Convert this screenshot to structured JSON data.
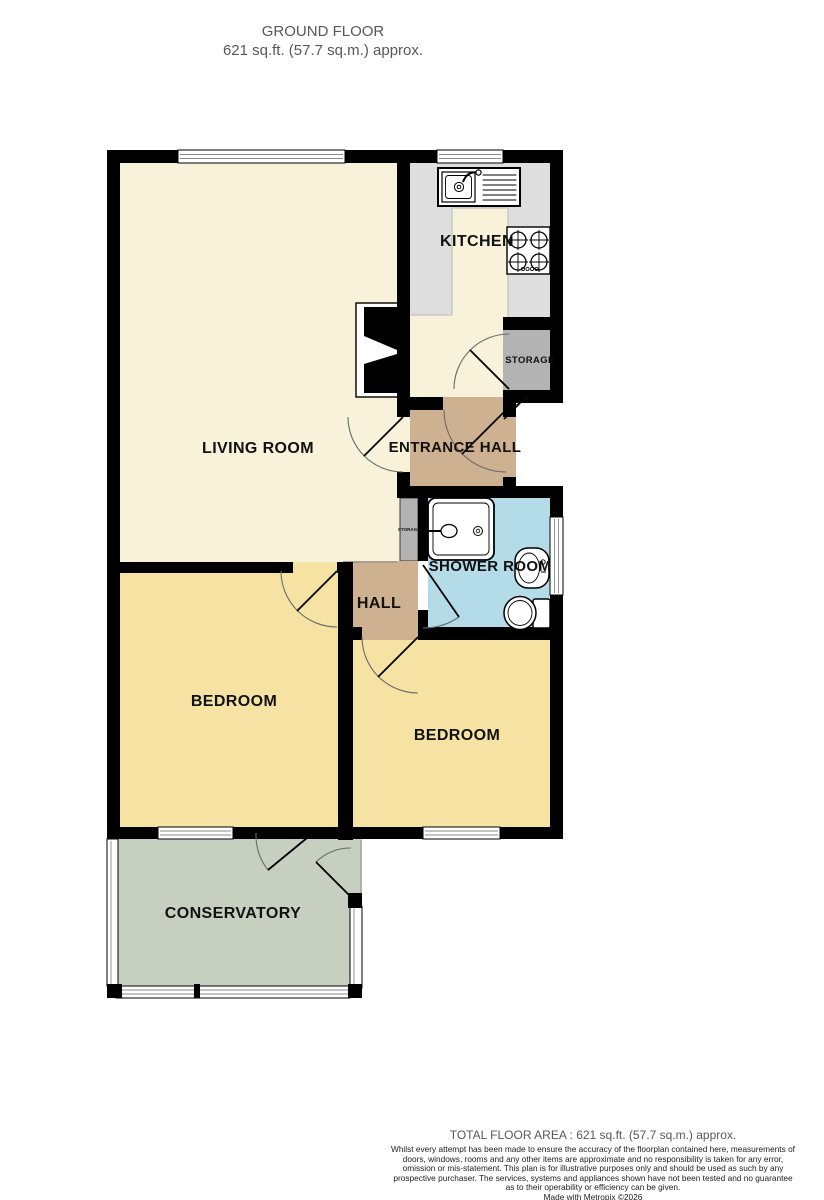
{
  "header": {
    "title": "GROUND FLOOR",
    "subtitle": "621 sq.ft. (57.7 sq.m.) approx."
  },
  "rooms": {
    "living_room": "LIVING ROOM",
    "kitchen": "KITCHEN",
    "storage": "STORAGE",
    "storage_small": "STORAGE",
    "entrance_hall": "ENTRANCE HALL",
    "shower_room": "SHOWER ROOM",
    "hall": "HALL",
    "bedroom_left": "BEDROOM",
    "bedroom_right": "BEDROOM",
    "conservatory": "CONSERVATORY"
  },
  "footer": {
    "total_area": "TOTAL FLOOR AREA : 621 sq.ft. (57.7 sq.m.) approx.",
    "disclaimer": "Whilst every attempt has been made to ensure the accuracy of the floorplan contained here, measurements of doors, windows, rooms and any other items are approximate and no responsibility is taken for any error, omission or mis-statement. This plan is for illustrative purposes only and should be used as such by any prospective purchaser. The services, systems and appliances shown have not been tested and no guarantee as to their operability or efficiency can be given.",
    "credit": "Made with Metropix ©2026"
  },
  "colors": {
    "cream": "#f8f2db",
    "yellow": "#f6e3a4",
    "tan": "#cdb190",
    "blue": "#b4dce8",
    "green": "#c6cfc0",
    "kitchen-gray": "#dedede",
    "storage-gray": "#b3b3b3",
    "wall": "#000000",
    "muted": "#58585a"
  }
}
